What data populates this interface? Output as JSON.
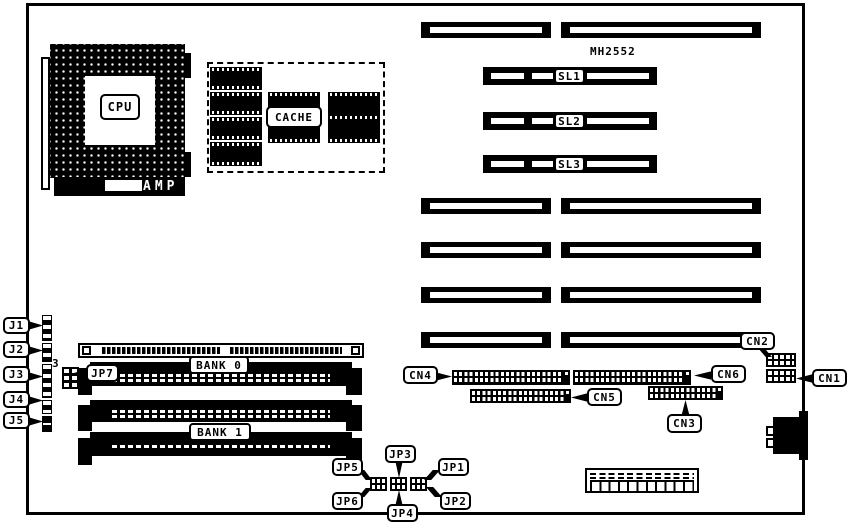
{
  "diagram": {
    "model": "MH2552",
    "cpu": {
      "label": "CPU",
      "brand": "AMP"
    },
    "cache": {
      "label": "CACHE"
    },
    "slots": {
      "sl1": "SL1",
      "sl2": "SL2",
      "sl3": "SL3"
    },
    "memory": {
      "bank0": "BANK 0",
      "bank1": "BANK 1"
    },
    "edge_connectors": {
      "j1": "J1",
      "j2": "J2",
      "j3": "J3",
      "j4": "J4",
      "j5": "J5"
    },
    "jumpers": {
      "jp1": "JP1",
      "jp2": "JP2",
      "jp3": "JP3",
      "jp4": "JP4",
      "jp5": "JP5",
      "jp6": "JP6",
      "jp7": "JP7",
      "jp7_pin3": "3",
      "jp7_pin4": "4"
    },
    "connectors": {
      "cn1": "CN1",
      "cn2": "CN2",
      "cn3": "CN3",
      "cn4": "CN4",
      "cn5": "CN5",
      "cn6": "CN6"
    },
    "colors": {
      "ink": "#000000",
      "paper": "#ffffff"
    }
  }
}
